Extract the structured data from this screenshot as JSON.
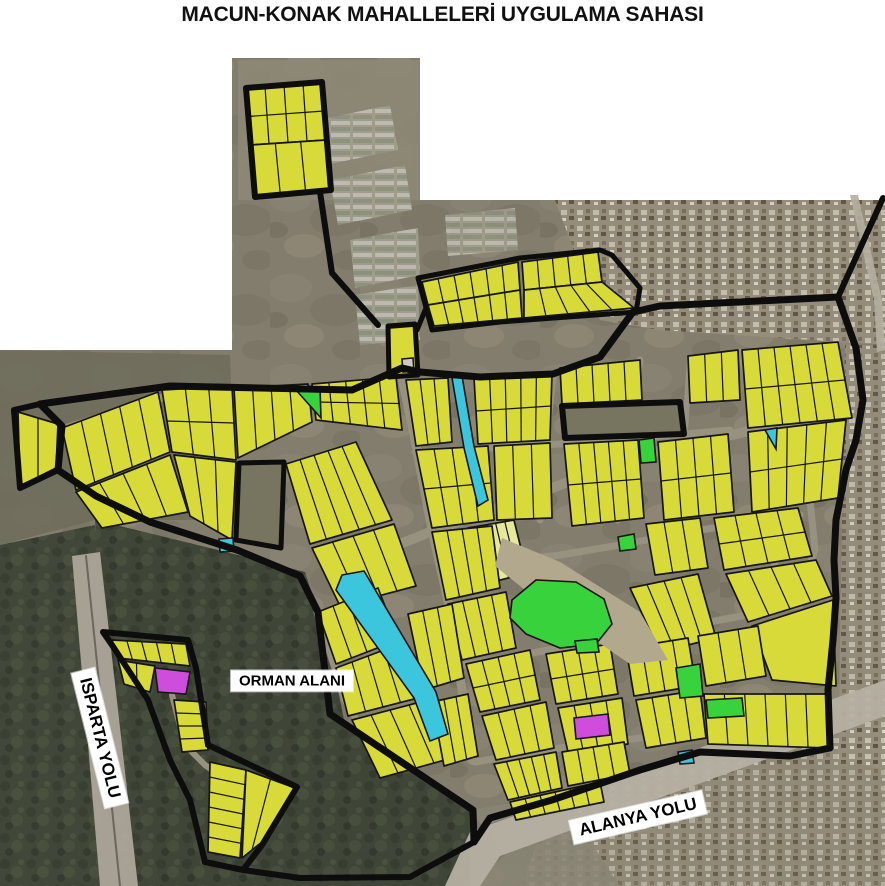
{
  "title": "MACUN-KONAK MAHALLELERİ UYGULAMA SAHASI",
  "colors": {
    "parcel": "#d8da3a",
    "parcel_light": "#e6e89c",
    "road": "#97917f",
    "boundary": "#0d0d0d",
    "line": "#161616",
    "park": "#38d23c",
    "water": "#3cc6de",
    "special": "#cf4ddd",
    "sat_base": "#837d6d",
    "forest": "#3c4334",
    "hole_fill": "#77755f",
    "riverbed": "#b2a88e",
    "highway": "#b6b0a2",
    "highway2": "#ada79a"
  },
  "map": {
    "width": 885,
    "height": 886,
    "satellite": {
      "region": "232,58 420,58 420,200 885,200 885,886 0,886 0,350 232,350",
      "patches": [
        {
          "name": "field-patch",
          "points": "238,60 420,60 420,200 238,200",
          "fill": "#8d8776",
          "opacity": 0.9
        },
        {
          "name": "greenhouse-patch",
          "points": "318,120 390,105 398,150 325,165",
          "pattern": "gh",
          "opacity": 0.85
        },
        {
          "name": "greenhouse-patch",
          "points": "330,180 405,165 412,210 338,225",
          "pattern": "gh",
          "opacity": 0.85
        },
        {
          "name": "greenhouse-patch",
          "points": "350,240 418,228 420,275 355,288",
          "pattern": "gh",
          "opacity": 0.85
        },
        {
          "name": "greenhouse-patch",
          "points": "355,295 418,285 420,340 360,345",
          "pattern": "gh",
          "opacity": 0.85
        },
        {
          "name": "greenhouse-patch",
          "points": "445,215 515,208 518,250 448,256",
          "pattern": "gh",
          "opacity": 0.8
        },
        {
          "name": "urban-patch",
          "points": "555,200 885,200 885,345 660,330 600,320",
          "pattern": "urban",
          "opacity": 0.9
        },
        {
          "name": "urban-patch",
          "points": "845,345 885,345 885,770 838,760",
          "pattern": "urban",
          "opacity": 0.85
        },
        {
          "name": "urban-patch",
          "points": "560,790 885,725 885,886 520,886",
          "pattern": "urban",
          "opacity": 0.7
        },
        {
          "name": "field-patch",
          "points": "0,350 230,355 235,520 95,520 0,545",
          "fill": "#6f6d5c",
          "opacity": 0.9
        },
        {
          "name": "forest-area",
          "points": "0,545 95,525 120,700 160,886 0,886",
          "pattern": "forest",
          "opacity": 0.92
        },
        {
          "name": "forest-area",
          "points": "95,520 210,548 305,572 330,650 345,725 470,810 505,855 470,886 160,886 105,640",
          "pattern": "forest",
          "opacity": 0.95
        },
        {
          "name": "field-patch",
          "points": "470,810 560,795 620,886 470,886",
          "fill": "#8a8575",
          "opacity": 0.85
        },
        {
          "name": "highway-isparta",
          "points": "72,556 100,552 138,886 100,886",
          "fill": "#ada79a",
          "opacity": 0.95
        },
        {
          "name": "highway-alanya",
          "points": "445,886 470,832 885,680 885,716 500,856 480,886",
          "fill": "#b6b0a2",
          "opacity": 0.95
        },
        {
          "name": "side-road",
          "points": "850,195 858,195 882,300 885,350 877,352 874,300",
          "fill": "#b4aea0",
          "opacity": 0.9
        }
      ]
    },
    "roads": [
      {
        "points": "60,430 170,395 350,392 400,370",
        "width": 8
      },
      {
        "points": "400,368 415,440 432,530 450,610 462,690 472,760",
        "width": 9
      },
      {
        "points": "335,570 430,532 520,500 640,455 745,432 835,418",
        "width": 10
      },
      {
        "points": "553,375 545,450 540,520",
        "width": 7
      },
      {
        "points": "640,360 628,440 618,520",
        "width": 7
      },
      {
        "points": "415,452 490,448 560,444 640,438 730,430",
        "width": 7
      },
      {
        "points": "460,585 520,560 560,555 620,545 700,530 800,515",
        "width": 7
      },
      {
        "points": "465,665 560,648 640,635 720,620 800,605",
        "width": 7
      },
      {
        "points": "475,762 560,748 640,738 720,728 800,718",
        "width": 7
      },
      {
        "points": "740,352 760,420 770,500 775,570",
        "width": 7
      },
      {
        "points": "755,430 790,460 810,500 815,550 800,590",
        "width": 7
      },
      {
        "points": "510,378 505,450",
        "width": 6
      },
      {
        "points": "690,358 685,430",
        "width": 6
      },
      {
        "points": "317,612 345,700 380,760",
        "width": 7
      },
      {
        "points": "172,695 185,745 205,765 240,790",
        "width": 6
      },
      {
        "points": "86,556 120,886",
        "width": 2,
        "color": "#6b675c"
      }
    ],
    "blocks": [
      {
        "quad": [
          246,
          88,
          322,
          82,
          326,
          140,
          250,
          145
        ],
        "div": 4,
        "row": true
      },
      {
        "quad": [
          250,
          145,
          326,
          140,
          331,
          190,
          255,
          197
        ],
        "div": 3
      },
      {
        "quad": [
          422,
          282,
          518,
          262,
          520,
          290,
          428,
          305
        ],
        "div": 6
      },
      {
        "quad": [
          428,
          305,
          520,
          290,
          522,
          318,
          434,
          326
        ],
        "div": 6
      },
      {
        "quad": [
          522,
          262,
          598,
          252,
          602,
          282,
          524,
          290
        ],
        "div": 5
      },
      {
        "quad": [
          524,
          290,
          602,
          282,
          634,
          308,
          524,
          318
        ],
        "div": 5
      },
      {
        "quad": [
          389,
          328,
          414,
          326,
          417,
          374,
          390,
          376
        ],
        "div": 1
      },
      {
        "quad": [
          18,
          412,
          58,
          424,
          56,
          468,
          20,
          486
        ],
        "div": 2
      },
      {
        "quad": [
          62,
          428,
          158,
          392,
          170,
          452,
          76,
          490
        ],
        "div": 5
      },
      {
        "quad": [
          76,
          492,
          170,
          455,
          188,
          512,
          102,
          528
        ],
        "div": 4
      },
      {
        "quad": [
          162,
          390,
          232,
          386,
          236,
          460,
          172,
          452
        ],
        "div": 3,
        "row": true
      },
      {
        "quad": [
          174,
          455,
          236,
          462,
          232,
          540,
          190,
          516
        ],
        "div": 3
      },
      {
        "quad": [
          234,
          388,
          308,
          384,
          312,
          422,
          238,
          458
        ],
        "div": 4
      },
      {
        "quad": [
          312,
          384,
          396,
          377,
          402,
          430,
          316,
          420
        ],
        "div": 5,
        "row": true
      },
      {
        "quad": [
          286,
          464,
          356,
          442,
          392,
          520,
          310,
          544
        ],
        "div": 5
      },
      {
        "quad": [
          312,
          548,
          394,
          524,
          416,
          586,
          340,
          606
        ],
        "div": 4
      },
      {
        "quad": [
          406,
          380,
          448,
          378,
          452,
          442,
          416,
          446
        ],
        "div": 3
      },
      {
        "quad": [
          474,
          378,
          552,
          372,
          550,
          440,
          478,
          444
        ],
        "div": 5,
        "row": true
      },
      {
        "quad": [
          416,
          450,
          488,
          446,
          494,
          520,
          432,
          528
        ],
        "div": 4,
        "row": true
      },
      {
        "quad": [
          494,
          446,
          550,
          443,
          552,
          518,
          497,
          520
        ],
        "div": 3
      },
      {
        "quad": [
          468,
          528,
          514,
          520,
          527,
          573,
          481,
          585
        ],
        "div": 5,
        "fill": "#e6e89c"
      },
      {
        "quad": [
          432,
          532,
          492,
          526,
          500,
          588,
          446,
          600
        ],
        "div": 4
      },
      {
        "quad": [
          448,
          604,
          506,
          592,
          516,
          648,
          462,
          660
        ],
        "div": 4
      },
      {
        "quad": [
          560,
          368,
          640,
          360,
          642,
          400,
          562,
          404
        ],
        "div": 5
      },
      {
        "quad": [
          688,
          356,
          738,
          350,
          740,
          400,
          690,
          403
        ],
        "div": 3
      },
      {
        "quad": [
          564,
          444,
          638,
          440,
          644,
          518,
          572,
          526
        ],
        "div": 5,
        "row": true
      },
      {
        "quad": [
          658,
          442,
          728,
          434,
          734,
          512,
          664,
          520
        ],
        "div": 4,
        "row": true
      },
      {
        "quad": [
          646,
          524,
          700,
          518,
          708,
          568,
          655,
          575
        ],
        "div": 3
      },
      {
        "quad": [
          742,
          350,
          838,
          342,
          852,
          418,
          748,
          428
        ],
        "div": 6,
        "row": true
      },
      {
        "quad": [
          748,
          432,
          846,
          420,
          838,
          498,
          752,
          512
        ],
        "div": 5,
        "row": true
      },
      {
        "quad": [
          714,
          518,
          798,
          508,
          812,
          556,
          724,
          570
        ],
        "div": 4,
        "row": true
      },
      {
        "quad": [
          726,
          574,
          816,
          560,
          832,
          596,
          748,
          622
        ],
        "div": 4
      },
      {
        "quad": [
          752,
          626,
          833,
          600,
          836,
          686,
          772,
          680
        ],
        "div": 1
      },
      {
        "quad": [
          630,
          588,
          698,
          574,
          716,
          638,
          660,
          652
        ],
        "div": 4
      },
      {
        "quad": [
          318,
          612,
          378,
          588,
          398,
          640,
          336,
          664
        ],
        "div": 4
      },
      {
        "quad": [
          336,
          668,
          400,
          644,
          418,
          698,
          348,
          716
        ],
        "div": 4
      },
      {
        "quad": [
          352,
          720,
          428,
          700,
          452,
          758,
          380,
          778
        ],
        "div": 4
      },
      {
        "quad": [
          408,
          614,
          452,
          604,
          464,
          678,
          424,
          690
        ],
        "div": 3
      },
      {
        "quad": [
          432,
          702,
          468,
          694,
          478,
          756,
          444,
          766
        ],
        "div": 3
      },
      {
        "quad": [
          466,
          664,
          530,
          650,
          540,
          700,
          480,
          712
        ],
        "div": 4,
        "row": true
      },
      {
        "quad": [
          482,
          716,
          546,
          702,
          554,
          748,
          496,
          760
        ],
        "div": 4
      },
      {
        "quad": [
          546,
          654,
          610,
          644,
          618,
          694,
          556,
          704
        ],
        "div": 4,
        "row": true
      },
      {
        "quad": [
          558,
          708,
          622,
          698,
          628,
          744,
          568,
          752
        ],
        "div": 4
      },
      {
        "quad": [
          626,
          648,
          688,
          638,
          696,
          686,
          634,
          696
        ],
        "div": 4
      },
      {
        "quad": [
          636,
          700,
          700,
          690,
          706,
          738,
          646,
          748
        ],
        "div": 4
      },
      {
        "quad": [
          698,
          636,
          758,
          626,
          766,
          676,
          706,
          686
        ],
        "div": 3
      },
      {
        "quad": [
          704,
          694,
          826,
          694,
          828,
          748,
          708,
          744
        ],
        "div": 6
      },
      {
        "quad": [
          494,
          764,
          556,
          752,
          562,
          788,
          508,
          800
        ],
        "div": 5
      },
      {
        "quad": [
          562,
          752,
          624,
          742,
          630,
          774,
          568,
          786
        ],
        "div": 4
      },
      {
        "quad": [
          510,
          802,
          600,
          782,
          604,
          802,
          516,
          820
        ],
        "div": 6
      },
      {
        "quad": [
          112,
          640,
          186,
          644,
          190,
          666,
          118,
          658
        ],
        "div": 5
      },
      {
        "quad": [
          118,
          660,
          155,
          666,
          150,
          692,
          124,
          684
        ],
        "div": 2
      },
      {
        "quad": [
          174,
          700,
          182,
          752,
          208,
          750,
          206,
          702
        ],
        "div": 4
      },
      {
        "quad": [
          210,
          762,
          208,
          852,
          240,
          858,
          246,
          770
        ],
        "div": 6
      },
      {
        "quad": [
          246,
          770,
          295,
          788,
          262,
          842,
          242,
          858
        ],
        "div": 2
      }
    ],
    "specials": [
      {
        "name": "riverbed",
        "points": "502,538 560,562 640,612 668,660 630,664 545,606 495,566",
        "fill_key": "riverbed",
        "nostroke": true
      },
      {
        "name": "park-parcel",
        "points": "512,600 536,580 576,582 604,599 612,624 596,644 560,648 526,634 510,618",
        "fill_key": "park"
      },
      {
        "name": "park-parcel",
        "points": "296,390 320,387 321,418",
        "fill_key": "park"
      },
      {
        "name": "park-parcel",
        "points": "639,440 654,438 656,462 641,463",
        "fill_key": "park"
      },
      {
        "name": "park-parcel",
        "points": "676,668 700,664 703,696 680,698",
        "fill_key": "park"
      },
      {
        "name": "park-parcel",
        "points": "706,700 742,698 744,716 708,718",
        "fill_key": "park"
      },
      {
        "name": "park-parcel",
        "points": "575,641 597,639 599,652 577,653",
        "fill_key": "park"
      },
      {
        "name": "park-parcel",
        "points": "618,537 634,534 636,549 620,551",
        "fill_key": "park"
      },
      {
        "name": "water-channel",
        "points": "452,378 462,376 474,446 488,500 478,506 464,448",
        "fill_key": "water"
      },
      {
        "name": "water-channel",
        "points": "342,575 364,571 436,692 448,734 430,741 414,698 336,590",
        "fill_key": "water"
      },
      {
        "name": "water-parcel",
        "points": "765,430 777,428 776,449",
        "fill_key": "water"
      },
      {
        "name": "water-parcel",
        "points": "219,539 233,538 234,551 220,552",
        "fill_key": "water"
      },
      {
        "name": "water-parcel",
        "points": "678,752 692,750 694,763 680,764",
        "fill_key": "water"
      },
      {
        "name": "special-parcel",
        "points": "574,718 608,714 610,735 576,739",
        "fill_key": "special"
      },
      {
        "name": "special-parcel",
        "points": "155,668 190,672 186,694 158,692",
        "fill_key": "special"
      },
      {
        "name": "reserved-parcel",
        "points": "402,359 413,358 414,371 403,372",
        "fill": "#cfcabc"
      }
    ],
    "holes": [
      {
        "name": "excluded-parcel",
        "points": "239,463 284,462 281,548 236,540",
        "width": 5
      },
      {
        "name": "excluded-parcel",
        "points": "562,406 680,402 684,434 565,438",
        "width": 6
      }
    ],
    "boundaries": [
      {
        "name": "area-boundary-main",
        "points": "40,404 170,386 352,390 402,368 420,372 480,377 553,374 600,357 633,312 660,306 838,297 856,348 863,400 856,440 846,470 836,520 834,560 836,598 833,640 828,690 830,748 790,756 700,752 640,770 552,800 490,818 474,842 473,810 330,714 318,612 300,576 237,550 150,522 96,496 58,470 62,426",
        "closed": true,
        "width": 7
      },
      {
        "name": "area-boundary-island",
        "points": "246,88 322,82 331,190 255,197",
        "closed": true,
        "width": 6
      },
      {
        "name": "area-boundary-strip",
        "points": "418,278 520,258 600,250 612,255 640,288 636,312 500,322 432,330",
        "closed": true,
        "width": 5
      },
      {
        "name": "area-boundary-block",
        "points": "388,326 415,324 418,375 389,377",
        "closed": true,
        "width": 5
      },
      {
        "name": "area-boundary-triangle",
        "points": "14,410 40,404 62,426 58,470 20,488",
        "closed": true,
        "width": 6
      },
      {
        "name": "area-boundary-pocket",
        "points": "103,632 188,640 196,668 208,745 297,787 262,845 243,870 205,862 190,800 170,760 148,700 112,645",
        "closed": true,
        "width": 6
      },
      {
        "name": "corridor-line",
        "points": "320,192 332,273 378,325",
        "closed": false,
        "width": 6
      },
      {
        "name": "corridor-line",
        "points": "417,330 426,308",
        "closed": false,
        "width": 5
      },
      {
        "name": "corridor-line",
        "points": "838,297 883,198",
        "closed": false,
        "width": 6
      },
      {
        "name": "corridor-line",
        "points": "205,862 243,870 300,878 410,877 474,842",
        "closed": false,
        "width": 6
      }
    ],
    "labels": [
      {
        "name": "road-label-isparta",
        "text": "ISPARTA YOLU",
        "x": 100,
        "y": 738,
        "rotate": 76,
        "size": 17
      },
      {
        "name": "area-label-orman",
        "text": "ORMAN ALANI",
        "x": 292,
        "y": 681,
        "rotate": 0,
        "size": 15
      },
      {
        "name": "road-label-alanya",
        "text": "ALANYA YOLU",
        "x": 638,
        "y": 817,
        "rotate": -13,
        "size": 17
      }
    ]
  }
}
